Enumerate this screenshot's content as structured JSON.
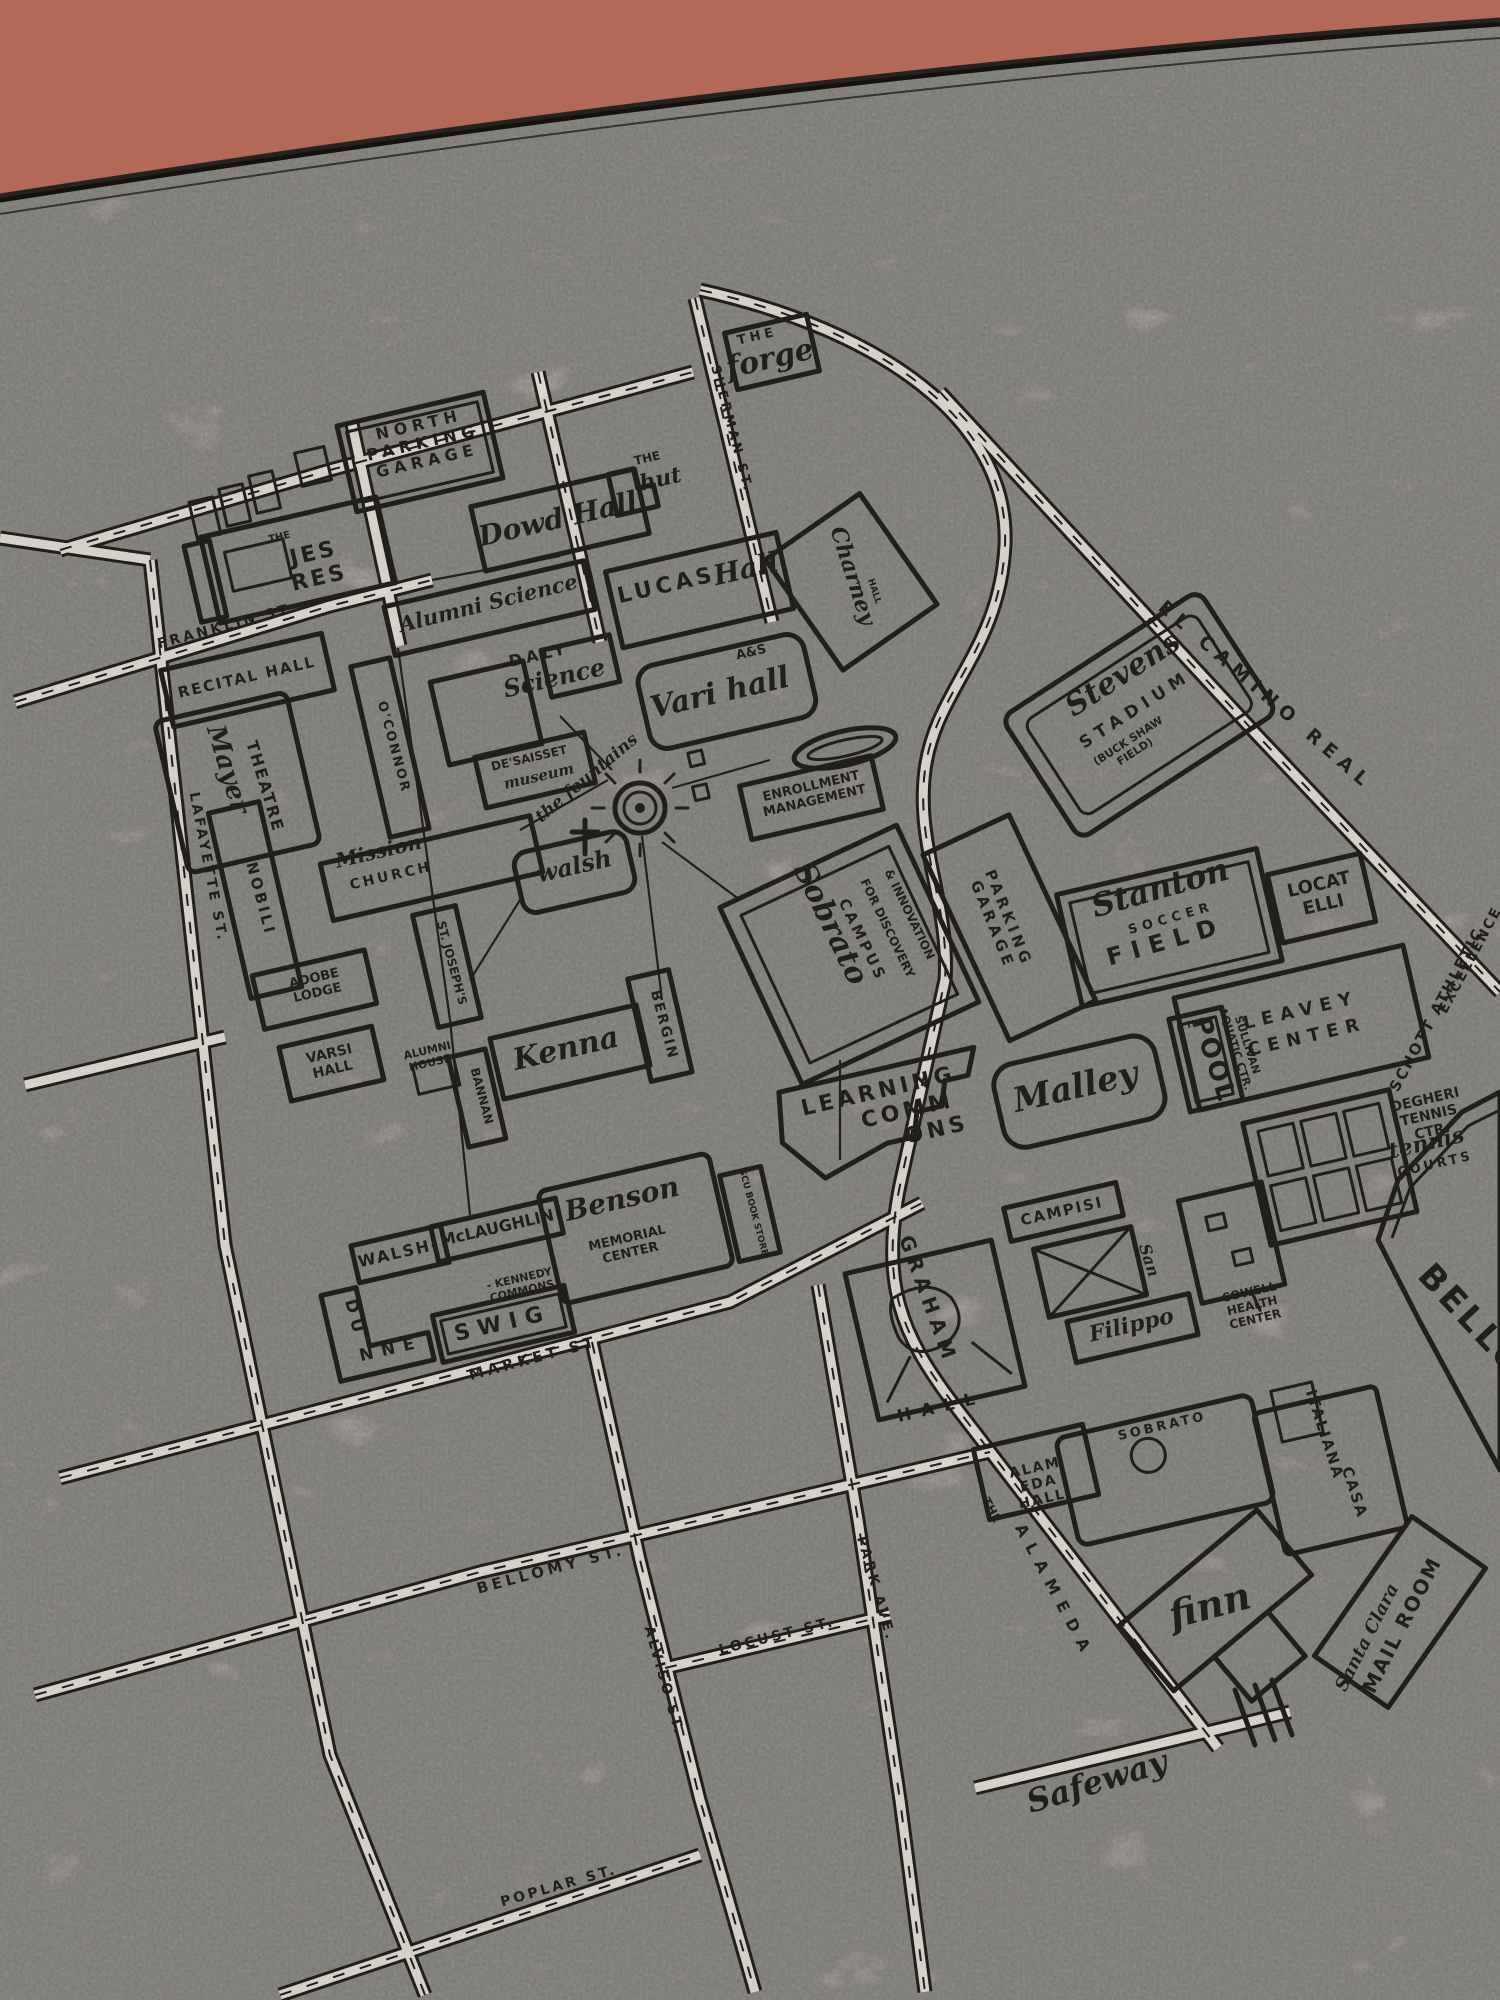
{
  "scene": {
    "description": "Hand-drawn Santa Clara University campus map printed in black ink on a cream flour-sack tea towel, photographed at a slight angle on a terracotta surface",
    "colors": {
      "backdrop": "#b26958",
      "towel": "#efeae1",
      "towel_edge": "#fdfaf3",
      "ink": "#26231f"
    }
  },
  "map": {
    "labels": [
      {
        "name": "the-forge-the",
        "text": "THE",
        "x": 758,
        "y": 340,
        "rot": -13,
        "size": 13,
        "style": "caps",
        "ls": 4
      },
      {
        "name": "the-forge",
        "text": "forge",
        "x": 772,
        "y": 368,
        "rot": -13,
        "size": 30,
        "style": "script"
      },
      {
        "name": "north-parking-garage",
        "lines": [
          "NORTH",
          "PARKING",
          "GARAGE"
        ],
        "x": 420,
        "y": 430,
        "rot": -13,
        "size": 16,
        "style": "caps",
        "ls": 5
      },
      {
        "name": "dowd-hall",
        "text": "Dowd Hall",
        "x": 560,
        "y": 528,
        "rot": -13,
        "size": 28,
        "style": "script"
      },
      {
        "name": "the-hut-the",
        "text": "THE",
        "x": 648,
        "y": 462,
        "rot": -13,
        "size": 12,
        "style": "caps"
      },
      {
        "name": "the-hut",
        "text": "hut",
        "x": 662,
        "y": 486,
        "rot": -13,
        "size": 22,
        "style": "script"
      },
      {
        "name": "sherman-st",
        "text": "SHERMAN ST.",
        "x": 728,
        "y": 430,
        "rot": 75,
        "size": 13,
        "style": "caps",
        "ls": 3
      },
      {
        "name": "jes-res-the",
        "text": "THE",
        "x": 280,
        "y": 540,
        "rot": -13,
        "size": 10,
        "style": "caps"
      },
      {
        "name": "jes-res",
        "lines": [
          "JES",
          "RES"
        ],
        "x": 315,
        "y": 560,
        "rot": -13,
        "size": 22,
        "style": "caps",
        "ls": 3
      },
      {
        "name": "franklin-st",
        "text": "FRANKLIN ST.",
        "x": 228,
        "y": 630,
        "rot": -15,
        "size": 14,
        "style": "caps",
        "ls": 3
      },
      {
        "name": "lucas-hall-lucas",
        "text": "LUCAS",
        "x": 668,
        "y": 592,
        "rot": -13,
        "size": 22,
        "style": "caps",
        "ls": 4
      },
      {
        "name": "lucas-hall-hall",
        "text": "Hall",
        "x": 748,
        "y": 578,
        "rot": -13,
        "size": 28,
        "style": "script"
      },
      {
        "name": "alumni-science",
        "text": "Alumni Science",
        "x": 490,
        "y": 610,
        "rot": -14,
        "size": 21,
        "style": "script"
      },
      {
        "name": "recital-hall",
        "text": "RECITAL HALL",
        "x": 248,
        "y": 682,
        "rot": -13,
        "size": 15,
        "style": "caps",
        "ls": 2
      },
      {
        "name": "daly-science-daly",
        "text": "DALY",
        "x": 540,
        "y": 660,
        "rot": -13,
        "size": 16,
        "style": "caps",
        "ls": 4
      },
      {
        "name": "daly-science",
        "text": "Science",
        "x": 556,
        "y": 686,
        "rot": -13,
        "size": 24,
        "style": "script"
      },
      {
        "name": "a-and-s",
        "text": "A&S",
        "x": 752,
        "y": 656,
        "rot": -13,
        "size": 13,
        "style": "caps"
      },
      {
        "name": "vari-hall",
        "text": "Vari hall",
        "x": 722,
        "y": 702,
        "rot": -13,
        "size": 30,
        "style": "script"
      },
      {
        "name": "charney-hall",
        "text": "Charney",
        "x": 846,
        "y": 578,
        "rot": 72,
        "size": 22,
        "style": "script"
      },
      {
        "name": "charney-hall-hall",
        "text": "HALL",
        "x": 872,
        "y": 592,
        "rot": 72,
        "size": 9,
        "style": "caps"
      },
      {
        "name": "oconnor",
        "text": "O'CONNOR",
        "x": 390,
        "y": 748,
        "rot": 75,
        "size": 13,
        "style": "caps",
        "ls": 2
      },
      {
        "name": "de-saisset",
        "text": "DE'SAISSET",
        "x": 530,
        "y": 762,
        "rot": -13,
        "size": 12,
        "style": "caps"
      },
      {
        "name": "de-saisset-museum",
        "text": "museum",
        "x": 540,
        "y": 781,
        "rot": -13,
        "size": 15,
        "style": "script"
      },
      {
        "name": "the-fountains",
        "text": "the fountains",
        "x": 590,
        "y": 782,
        "rot": -40,
        "size": 17,
        "style": "script"
      },
      {
        "name": "mayer-theatre-mayer",
        "text": "Mayer",
        "x": 220,
        "y": 772,
        "rot": 73,
        "size": 26,
        "style": "script"
      },
      {
        "name": "mayer-theatre",
        "text": "THEATRE",
        "x": 260,
        "y": 788,
        "rot": 73,
        "size": 16,
        "style": "caps",
        "ls": 2
      },
      {
        "name": "nobili",
        "text": "NOBILI",
        "x": 256,
        "y": 900,
        "rot": 75,
        "size": 15,
        "style": "caps",
        "ls": 3
      },
      {
        "name": "lafayette-st",
        "text": "LAFAYETTE ST.",
        "x": 204,
        "y": 868,
        "rot": 79,
        "size": 14,
        "style": "caps",
        "ls": 3
      },
      {
        "name": "mission-church-mission",
        "text": "Mission",
        "x": 380,
        "y": 858,
        "rot": -13,
        "size": 20,
        "style": "script"
      },
      {
        "name": "mission-church",
        "text": "CHURCH",
        "x": 392,
        "y": 880,
        "rot": -13,
        "size": 14,
        "style": "caps",
        "ls": 3
      },
      {
        "name": "walsh-hall",
        "text": "walsh",
        "x": 576,
        "y": 874,
        "rot": -13,
        "size": 24,
        "style": "script"
      },
      {
        "name": "enrollment-management",
        "lines": [
          "ENROLLMENT",
          "MANAGEMENT"
        ],
        "x": 812,
        "y": 790,
        "rot": -13,
        "size": 13,
        "style": "caps"
      },
      {
        "name": "stevens-stadium-stevens",
        "text": "Stevens",
        "x": 1128,
        "y": 682,
        "rot": -33,
        "size": 30,
        "style": "script"
      },
      {
        "name": "stevens-stadium",
        "text": "STADIUM",
        "x": 1138,
        "y": 714,
        "rot": -33,
        "size": 17,
        "style": "caps",
        "ls": 6
      },
      {
        "name": "buck-shaw-field",
        "lines": [
          "(BUCK SHAW",
          "FIELD)"
        ],
        "x": 1130,
        "y": 744,
        "rot": -33,
        "size": 11,
        "style": "caps"
      },
      {
        "name": "el-camino-real",
        "text": "EL CAMINO REAL",
        "x": 1262,
        "y": 700,
        "rot": 41,
        "size": 19,
        "style": "caps",
        "ls": 7
      },
      {
        "name": "parking-garage",
        "lines": [
          "PARKING",
          "GARAGE"
        ],
        "x": 1004,
        "y": 920,
        "rot": 68,
        "size": 15,
        "style": "caps",
        "ls": 4
      },
      {
        "name": "sobrato-campus-sobrato",
        "text": "Sobrato",
        "x": 822,
        "y": 928,
        "rot": 64,
        "size": 30,
        "style": "script"
      },
      {
        "name": "sobrato-campus-campus",
        "text": "CAMPUS",
        "x": 858,
        "y": 942,
        "rot": 64,
        "size": 15,
        "style": "caps",
        "ls": 3
      },
      {
        "name": "sobrato-campus-discovery",
        "text": "FOR DISCOVERY",
        "x": 884,
        "y": 930,
        "rot": 64,
        "size": 12,
        "style": "caps"
      },
      {
        "name": "sobrato-campus-innovation",
        "text": "& INNOVATION",
        "x": 906,
        "y": 916,
        "rot": 64,
        "size": 12,
        "style": "caps"
      },
      {
        "name": "stanton-stanton",
        "text": "Stanton",
        "x": 1163,
        "y": 898,
        "rot": -16,
        "size": 32,
        "style": "script"
      },
      {
        "name": "stanton-soccer",
        "text": "SOCCER",
        "x": 1172,
        "y": 922,
        "rot": -16,
        "size": 13,
        "style": "caps",
        "ls": 5
      },
      {
        "name": "stanton-field",
        "text": "FIELD",
        "x": 1168,
        "y": 949,
        "rot": -16,
        "size": 24,
        "style": "caps",
        "ls": 9
      },
      {
        "name": "locatelli",
        "lines": [
          "LOCAT",
          "ELLI"
        ],
        "x": 1320,
        "y": 890,
        "rot": -13,
        "size": 18,
        "style": "caps"
      },
      {
        "name": "schott-athletic",
        "text": "SCHOTT ATHLETIC",
        "x": 1441,
        "y": 1012,
        "rot": -62,
        "size": 15,
        "style": "caps",
        "ls": 2
      },
      {
        "name": "schott-excellence",
        "text": "EXCELLENCE",
        "x": 1474,
        "y": 962,
        "rot": -62,
        "size": 14,
        "style": "caps",
        "ls": 2
      },
      {
        "name": "pool-the",
        "text": "THE",
        "x": 1196,
        "y": 1026,
        "rot": -13,
        "size": 9,
        "style": "caps"
      },
      {
        "name": "pool",
        "text": "POOL",
        "x": 1206,
        "y": 1062,
        "rot": 72,
        "size": 26,
        "style": "caps",
        "ls": 2
      },
      {
        "name": "sullivan-aquatic",
        "lines": [
          "SULLIVAN",
          "AQUATIC CTR."
        ],
        "x": 1244,
        "y": 1046,
        "rot": 72,
        "size": 11,
        "style": "caps"
      },
      {
        "name": "leavey-center",
        "lines": [
          "LEAVEY",
          "CENTER"
        ],
        "x": 1302,
        "y": 1016,
        "rot": -13,
        "size": 18,
        "style": "caps",
        "ls": 7,
        "lh": 1.5
      },
      {
        "name": "malley",
        "text": "Malley",
        "x": 1078,
        "y": 1098,
        "rot": -13,
        "size": 34,
        "style": "script"
      },
      {
        "name": "degheri-tennis-ctr",
        "lines": [
          "DEGHERI",
          "TENNIS",
          "CTR."
        ],
        "x": 1426,
        "y": 1104,
        "rot": -13,
        "size": 14,
        "style": "caps"
      },
      {
        "name": "tennis-script",
        "text": "tennis",
        "x": 1428,
        "y": 1150,
        "rot": -13,
        "size": 22,
        "style": "script"
      },
      {
        "name": "tennis-courts",
        "text": "COURTS",
        "x": 1436,
        "y": 1168,
        "rot": -13,
        "size": 13,
        "style": "caps",
        "ls": 3
      },
      {
        "name": "learning-commons",
        "lines": [
          "LEARNING",
          "COMM",
          "ONS"
        ],
        "x": 880,
        "y": 1098,
        "rot": -13,
        "size": 22,
        "style": "caps",
        "ls": 4,
        "dx": 24
      },
      {
        "name": "kenna",
        "text": "Kenna",
        "x": 568,
        "y": 1058,
        "rot": -13,
        "size": 30,
        "style": "script"
      },
      {
        "name": "bergin",
        "text": "BERGIN",
        "x": 660,
        "y": 1026,
        "rot": 75,
        "size": 14,
        "style": "caps",
        "ls": 2
      },
      {
        "name": "st-josephs",
        "text": "ST. JOSEPH'S",
        "x": 448,
        "y": 964,
        "rot": 75,
        "size": 12,
        "style": "caps"
      },
      {
        "name": "adobe-lodge",
        "lines": [
          "ADOBE",
          "LODGE"
        ],
        "x": 315,
        "y": 982,
        "rot": -13,
        "size": 13,
        "style": "caps"
      },
      {
        "name": "varsi-hall",
        "lines": [
          "VARSI",
          "HALL"
        ],
        "x": 330,
        "y": 1058,
        "rot": -13,
        "size": 14,
        "style": "caps"
      },
      {
        "name": "alumni-house",
        "lines": [
          "ALUMNI",
          "HOUSE"
        ],
        "x": 428,
        "y": 1054,
        "rot": -13,
        "size": 11,
        "style": "caps"
      },
      {
        "name": "bannan",
        "text": "BANNAN",
        "x": 478,
        "y": 1097,
        "rot": 75,
        "size": 12,
        "style": "caps"
      },
      {
        "name": "walsh-hyphen",
        "text": "WALSH-",
        "x": 400,
        "y": 1258,
        "rot": -13,
        "size": 16,
        "style": "caps",
        "ls": 2
      },
      {
        "name": "mclaughlin",
        "text": "McLAUGHLIN",
        "x": 498,
        "y": 1233,
        "rot": -13,
        "size": 16,
        "style": "caps"
      },
      {
        "name": "kennedy-commons",
        "lines": [
          "- KENNEDY",
          "COMMONS"
        ],
        "x": 520,
        "y": 1282,
        "rot": -13,
        "size": 11,
        "style": "caps"
      },
      {
        "name": "benson",
        "text": "Benson",
        "x": 624,
        "y": 1208,
        "rot": -13,
        "size": 28,
        "style": "script"
      },
      {
        "name": "benson-memorial-center",
        "lines": [
          "MEMORIAL",
          "CENTER"
        ],
        "x": 628,
        "y": 1242,
        "rot": -13,
        "size": 13,
        "style": "caps"
      },
      {
        "name": "scu-book-store",
        "text": "SCU BOOK STORE",
        "x": 751,
        "y": 1213,
        "rot": 75,
        "size": 9,
        "style": "caps"
      },
      {
        "name": "swig",
        "text": "SWIG",
        "x": 504,
        "y": 1330,
        "rot": -13,
        "size": 22,
        "style": "caps",
        "ls": 8
      },
      {
        "name": "dunne-du",
        "text": "DU",
        "x": 350,
        "y": 1320,
        "rot": 75,
        "size": 17,
        "style": "caps",
        "ls": 6
      },
      {
        "name": "dunne-nne",
        "text": "NNE",
        "x": 392,
        "y": 1354,
        "rot": -13,
        "size": 17,
        "style": "caps",
        "ls": 8
      },
      {
        "name": "market-st",
        "text": "MARKET ST.",
        "x": 538,
        "y": 1362,
        "rot": -15,
        "size": 15,
        "style": "caps",
        "ls": 4
      },
      {
        "name": "graham",
        "text": "GRAHAM",
        "x": 922,
        "y": 1302,
        "rot": 70,
        "size": 20,
        "style": "caps",
        "ls": 6
      },
      {
        "name": "graham-hall",
        "text": "HALL",
        "x": 942,
        "y": 1412,
        "rot": -13,
        "size": 17,
        "style": "caps",
        "ls": 10
      },
      {
        "name": "campisi",
        "text": "CAMPISI",
        "x": 1063,
        "y": 1216,
        "rot": -13,
        "size": 15,
        "style": "caps",
        "ls": 2
      },
      {
        "name": "san-filippo-san",
        "text": "San",
        "x": 1144,
        "y": 1262,
        "rot": 72,
        "size": 16,
        "style": "script"
      },
      {
        "name": "filippo",
        "text": "Filippo",
        "x": 1133,
        "y": 1332,
        "rot": -13,
        "size": 22,
        "style": "script"
      },
      {
        "name": "cowell-health-center",
        "lines": [
          "COWELL",
          "HEALTH",
          "CENTER"
        ],
        "x": 1250,
        "y": 1296,
        "rot": -13,
        "size": 12,
        "style": "caps"
      },
      {
        "name": "bellomy-field",
        "text": "BELLO",
        "x": 1464,
        "y": 1328,
        "rot": 47,
        "size": 34,
        "style": "caps",
        "ls": 4
      },
      {
        "name": "alameda-hall",
        "lines": [
          "ALAM",
          "EDA",
          "HALL"
        ],
        "x": 1036,
        "y": 1472,
        "rot": -13,
        "size": 14,
        "style": "caps",
        "ls": 2
      },
      {
        "name": "sobrato-hall",
        "text": "SOBRATO",
        "x": 1163,
        "y": 1430,
        "rot": -13,
        "size": 13,
        "style": "caps",
        "ls": 3
      },
      {
        "name": "casa-italiana-casa",
        "text": "CASA",
        "x": 1350,
        "y": 1494,
        "rot": 72,
        "size": 15,
        "style": "caps",
        "ls": 2
      },
      {
        "name": "casa-italiana",
        "text": "ITALIANA",
        "x": 1320,
        "y": 1436,
        "rot": 72,
        "size": 15,
        "style": "caps",
        "ls": 2
      },
      {
        "name": "finn",
        "text": "finn",
        "x": 1213,
        "y": 1618,
        "rot": -15,
        "size": 38,
        "style": "script"
      },
      {
        "name": "the-alameda-the",
        "text": "THE",
        "x": 988,
        "y": 1512,
        "rot": 62,
        "size": 12,
        "style": "caps"
      },
      {
        "name": "the-alameda",
        "text": "ALAMEDA",
        "x": 1050,
        "y": 1594,
        "rot": 62,
        "size": 16,
        "style": "caps",
        "ls": 9
      },
      {
        "name": "santa-clara",
        "text": "Santa Clara",
        "x": 1372,
        "y": 1640,
        "rot": -63,
        "size": 18,
        "style": "script"
      },
      {
        "name": "mail-room",
        "text": "MAIL ROOM",
        "x": 1408,
        "y": 1628,
        "rot": -63,
        "size": 20,
        "style": "caps",
        "ls": 2
      },
      {
        "name": "safeway",
        "text": "Safeway",
        "x": 1100,
        "y": 1792,
        "rot": -17,
        "size": 32,
        "style": "script"
      },
      {
        "name": "bellomy-st",
        "text": "BELLOMY ST.",
        "x": 552,
        "y": 1574,
        "rot": -15,
        "size": 15,
        "style": "caps",
        "ls": 4
      },
      {
        "name": "alviso-st",
        "text": "ALVISO ST.",
        "x": 660,
        "y": 1682,
        "rot": 74,
        "size": 14,
        "style": "caps",
        "ls": 3
      },
      {
        "name": "locust-st",
        "text": "LOCUST ST.",
        "x": 778,
        "y": 1640,
        "rot": -14,
        "size": 14,
        "style": "caps",
        "ls": 3
      },
      {
        "name": "park-ave",
        "text": "PARK AVE.",
        "x": 872,
        "y": 1590,
        "rot": 74,
        "size": 14,
        "style": "caps",
        "ls": 3
      },
      {
        "name": "poplar-st",
        "text": "POPLAR ST.",
        "x": 560,
        "y": 1890,
        "rot": -16,
        "size": 14,
        "style": "caps",
        "ls": 3
      }
    ]
  }
}
